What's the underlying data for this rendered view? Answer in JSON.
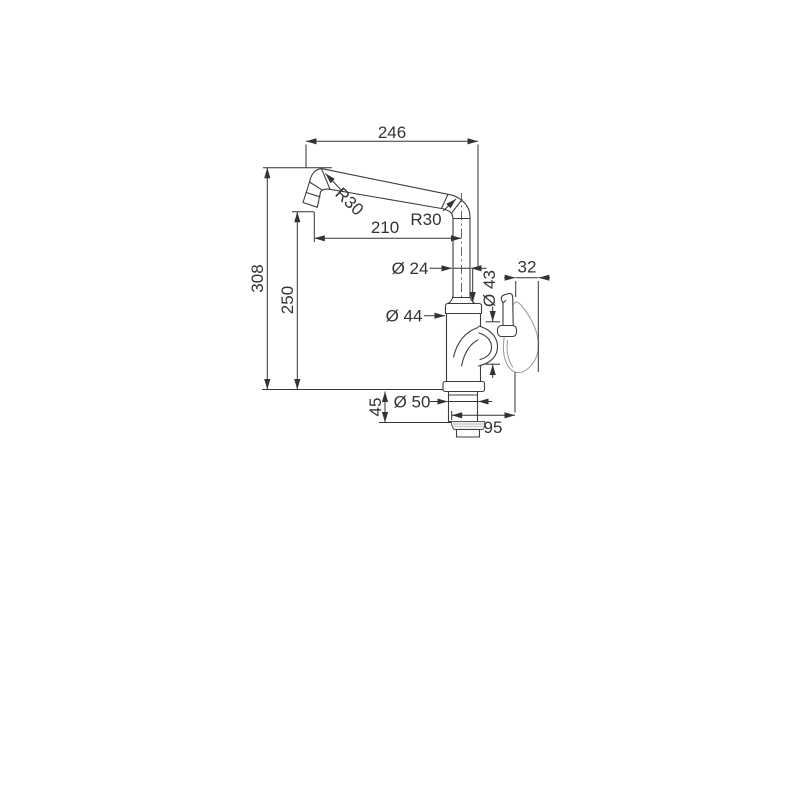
{
  "drawing": {
    "dims": {
      "spout_width": "246",
      "overall_height": "308",
      "spout_height": "250",
      "spout_reach": "210",
      "radius_left": "R30",
      "radius_right": "R30",
      "pipe_diameter": "Ø 24",
      "body_diameter": "Ø 44",
      "handle_diameter": "Ø 43",
      "handle_width": "32",
      "shank_height": "45",
      "shank_diameter": "Ø 50",
      "base_depth": "95"
    },
    "colors": {
      "outline": "#3d3d3d",
      "dimension": "#333333",
      "handle_outline": "#999999",
      "background": "#ffffff"
    }
  }
}
